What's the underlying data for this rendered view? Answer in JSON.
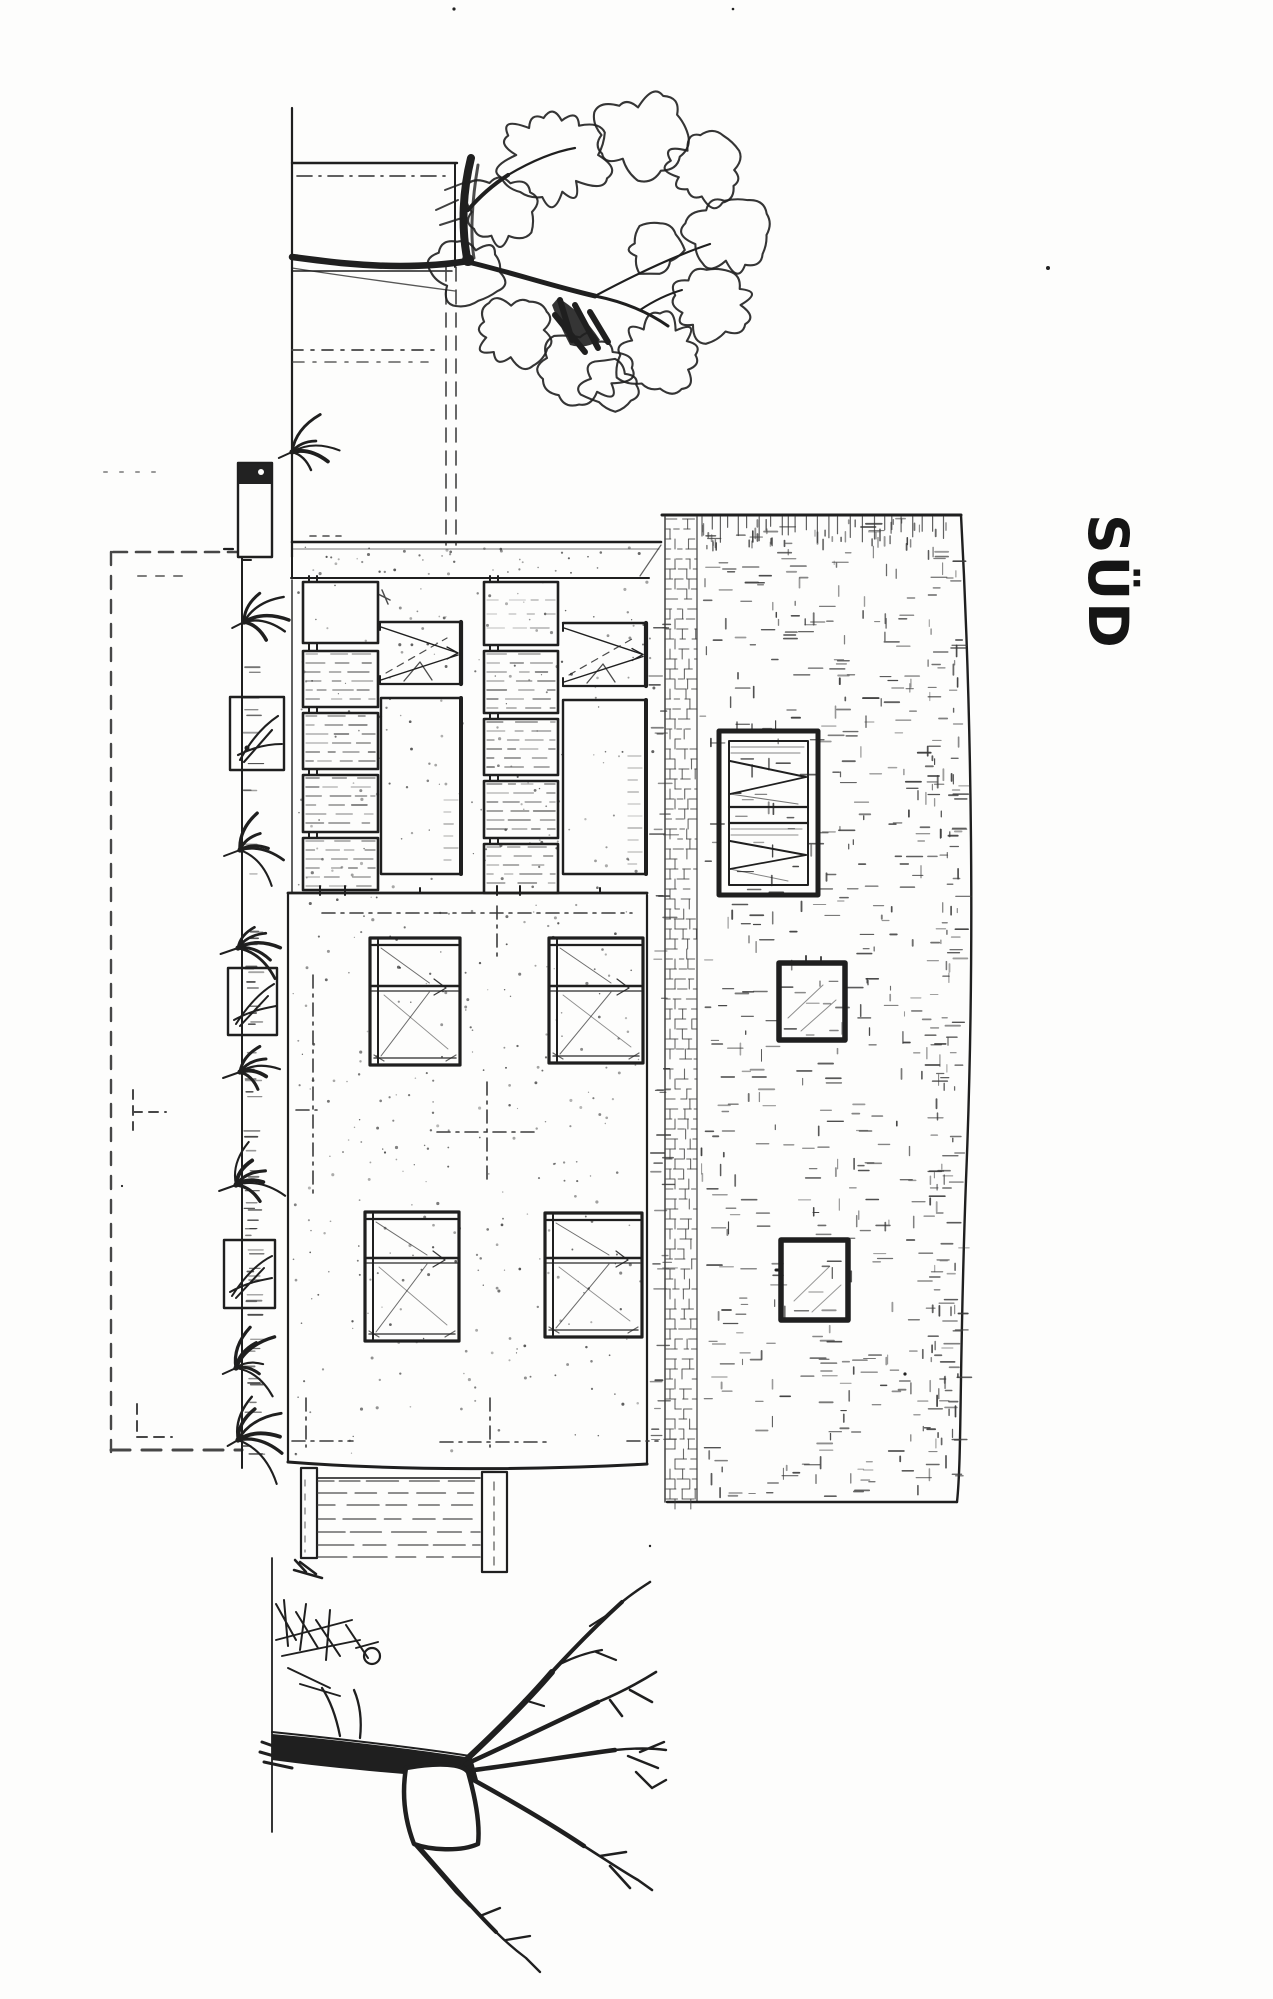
{
  "label": {
    "text": "SÜD"
  },
  "colors": {
    "ink": "#1f1f1f",
    "ink_soft": "#3a3a3a",
    "ink_faint": "#555555",
    "paper": "#fdfdfc"
  }
}
